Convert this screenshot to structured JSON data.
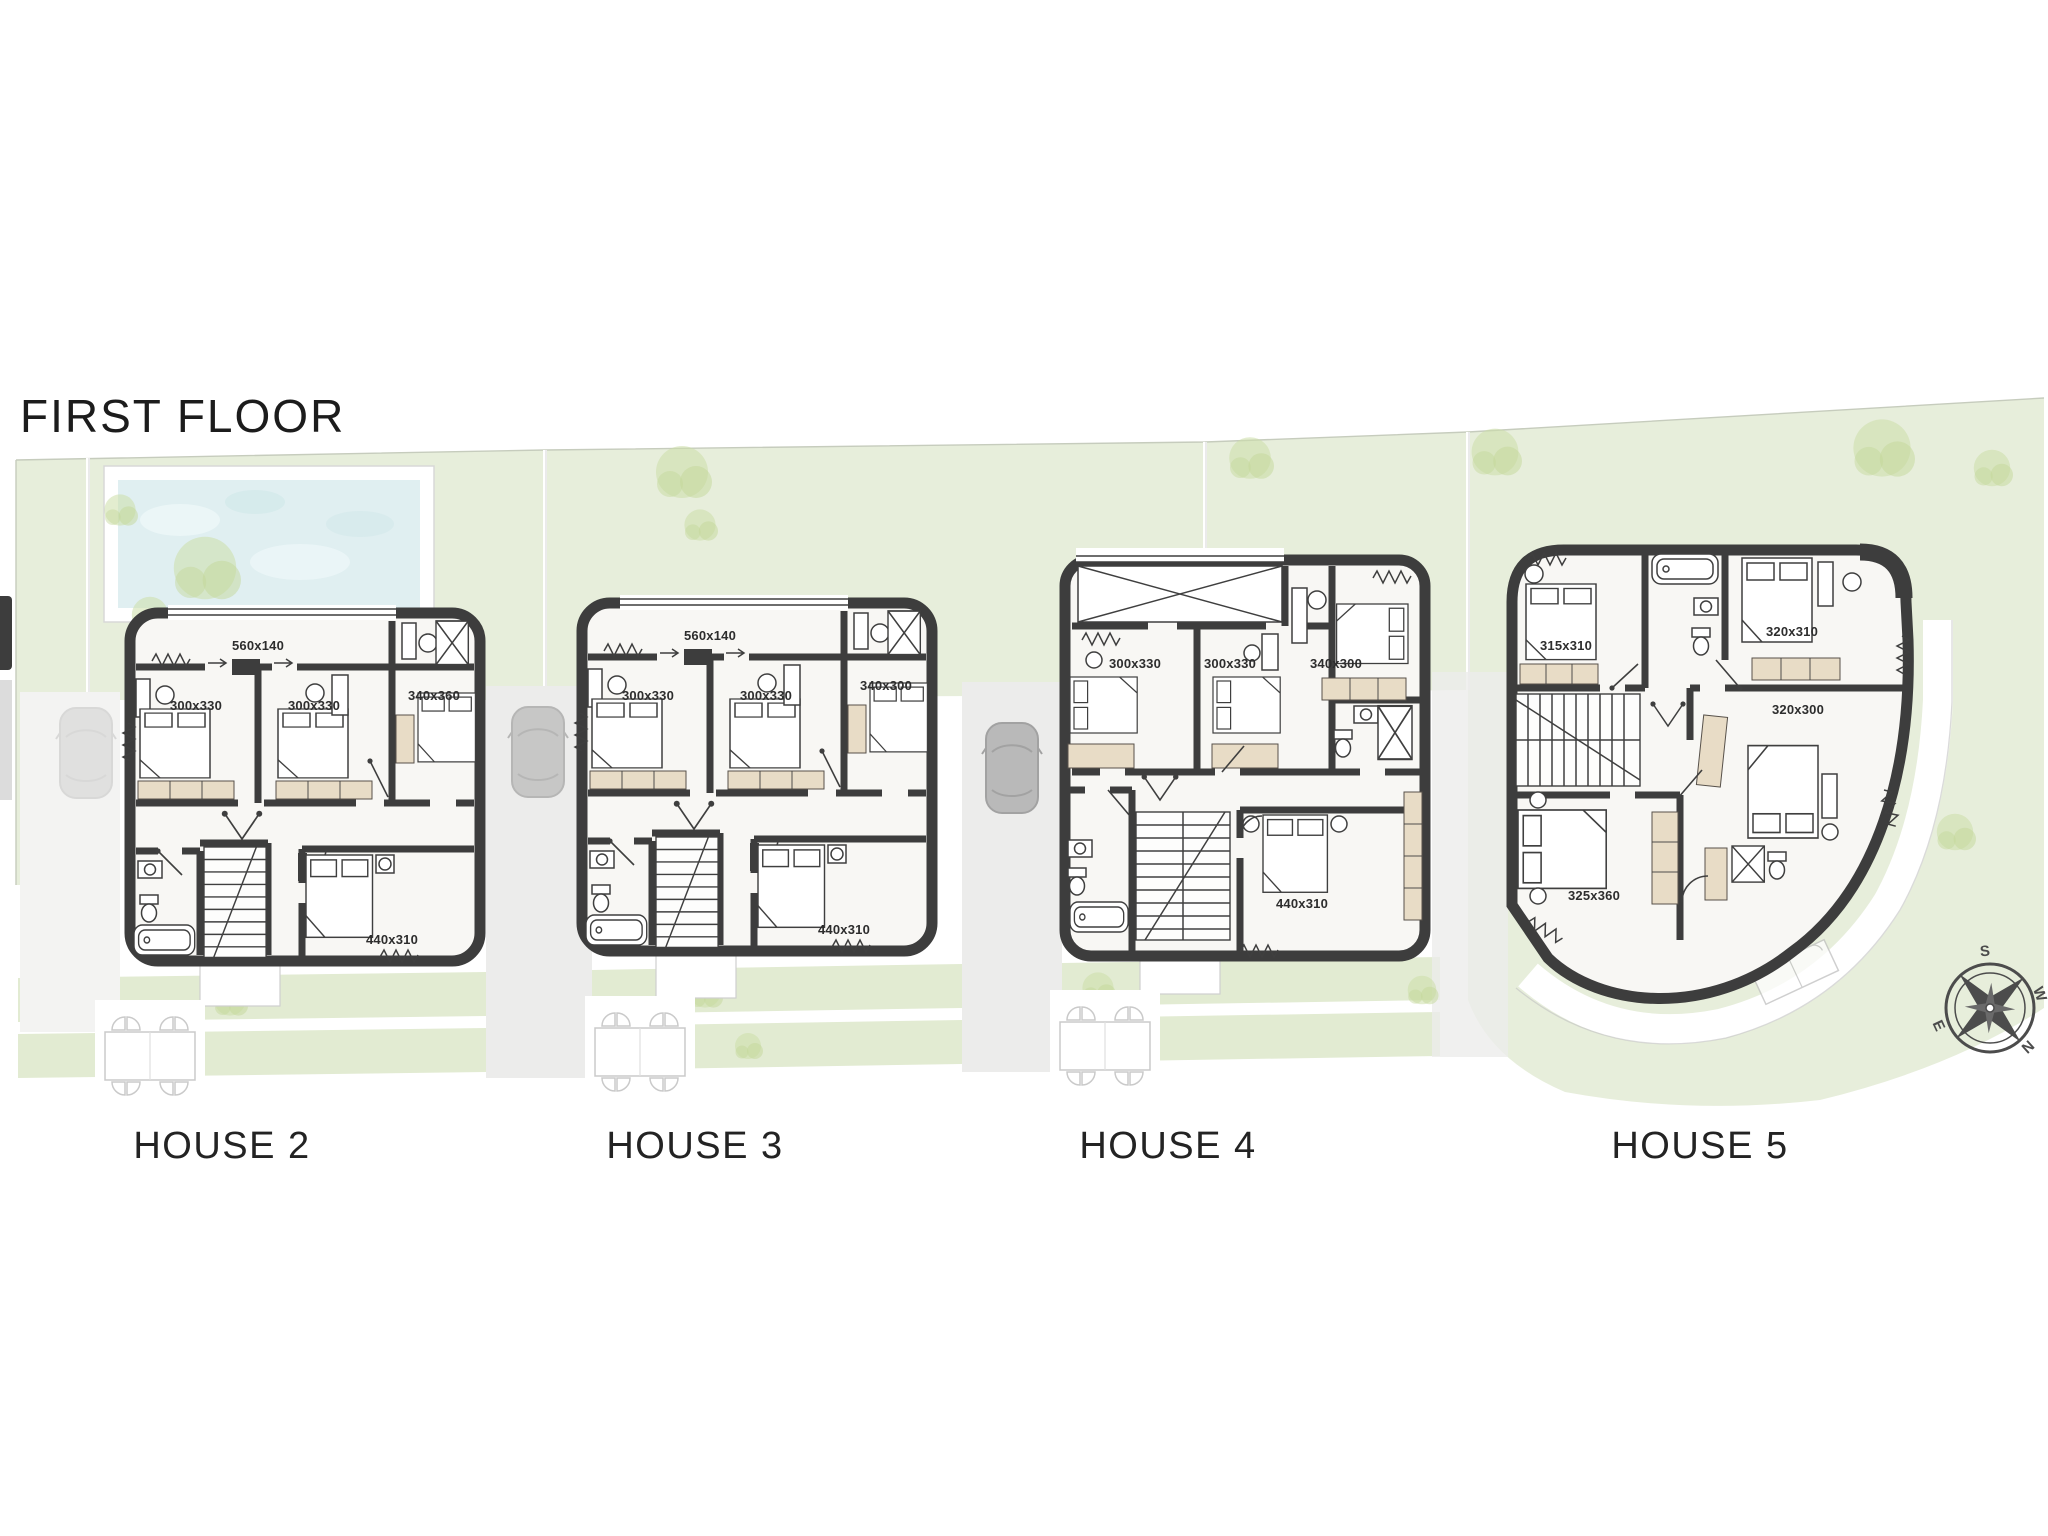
{
  "page": {
    "title": "FIRST FLOOR"
  },
  "plan": {
    "houses": [
      {
        "label": "HOUSE 2",
        "dims": {
          "balcony": "560x140",
          "bedroom_1": "300x330",
          "bedroom_2": "300x330",
          "bedroom_3": "340x360",
          "master_bedroom": "440x310"
        }
      },
      {
        "label": "HOUSE 3",
        "dims": {
          "balcony": "560x140",
          "bedroom_1": "300x330",
          "bedroom_2": "300x330",
          "bedroom_3": "340x300",
          "master_bedroom": "440x310"
        }
      },
      {
        "label": "HOUSE 4",
        "dims": {
          "bedroom_1": "300x330",
          "bedroom_2": "300x330",
          "bedroom_3": "340x300",
          "master_bedroom": "440x310"
        }
      },
      {
        "label": "HOUSE 5",
        "dims": {
          "bedroom_1": "315x310",
          "bedroom_2": "320x310",
          "bedroom_3": "320x300",
          "master_bedroom": "325x360"
        }
      }
    ],
    "compass": {
      "north": "N",
      "south": "S",
      "east": "E",
      "west": "W",
      "north_color": "#e0562e"
    },
    "colors": {
      "wall": "#3d3d3d",
      "garden": "#e7eedb",
      "pool": "#e0eff1",
      "wood": "#e8dcc6"
    }
  }
}
